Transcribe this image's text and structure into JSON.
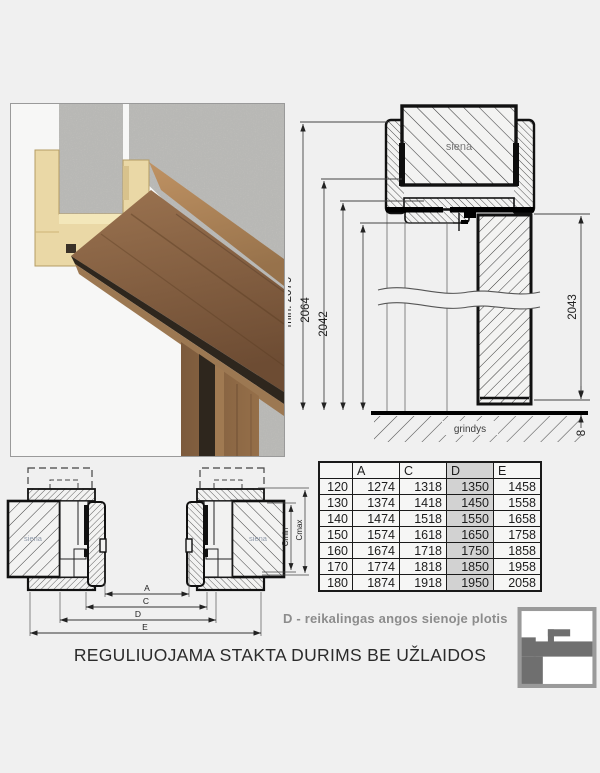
{
  "title": "REGULIUOJAMA STAKTA DURIMS BE UŽLAIDOS",
  "caption": "D - reikalingas angos sienoje plotis",
  "top_drawing": {
    "wall_label": "siena",
    "floor_label": "grindys",
    "dim_total_height": "2134",
    "dim_min_opening": "min. 2079",
    "dim_frame_outer": "2064",
    "dim_frame_inner": "2042",
    "dim_door_height": "2043",
    "dim_floor_gap": "8"
  },
  "plan_drawing": {
    "wall_label_left": "siena",
    "wall_label_right": "siena",
    "dim_a": "A",
    "dim_c": "C",
    "dim_d": "D",
    "dim_e": "E",
    "dim_cmin": "Cmin",
    "dim_cmax": "Cmax"
  },
  "table": {
    "headers": [
      "",
      "A",
      "C",
      "D",
      "E"
    ],
    "highlight_column": "D",
    "rows": [
      [
        120,
        1274,
        1318,
        1350,
        1458
      ],
      [
        130,
        1374,
        1418,
        1450,
        1558
      ],
      [
        140,
        1474,
        1518,
        1550,
        1658
      ],
      [
        150,
        1574,
        1618,
        1650,
        1758
      ],
      [
        160,
        1674,
        1718,
        1750,
        1858
      ],
      [
        170,
        1774,
        1818,
        1850,
        1958
      ],
      [
        180,
        1874,
        1918,
        1950,
        2058
      ]
    ]
  },
  "colors": {
    "page_background": "#f0f0f0",
    "caption_gray": "#8c8c8c",
    "table_highlight": "#d2d2d2",
    "logo_gray": "#6f6f6f",
    "wood_brown": "#8a6546",
    "profile_cream": "#ead8a6"
  }
}
